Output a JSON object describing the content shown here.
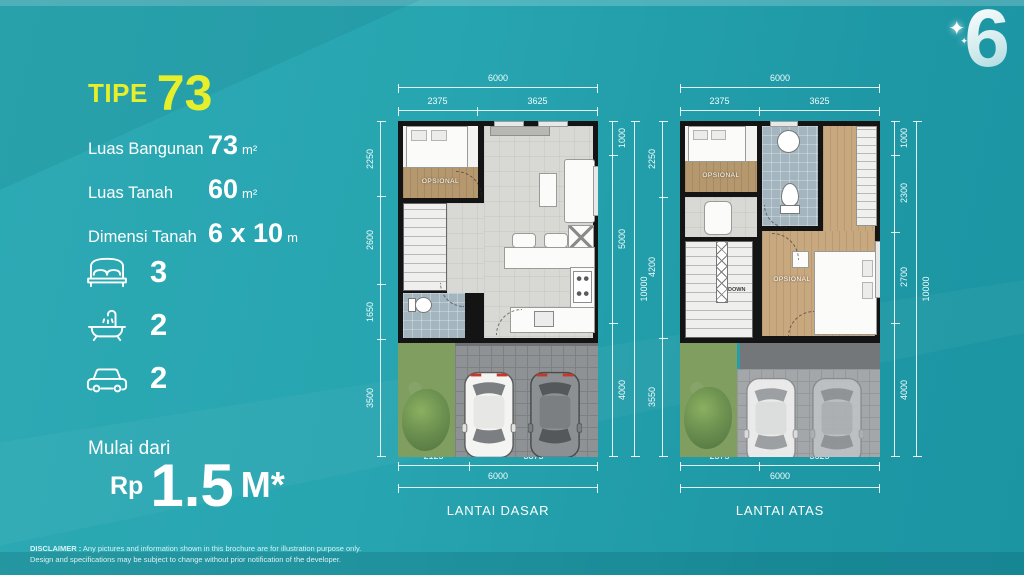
{
  "logo": {
    "text": "6",
    "sparkle": "✦"
  },
  "title": {
    "prefix": "TIPE",
    "number": "73"
  },
  "specs": [
    {
      "label": "Luas Bangunan",
      "value": "73",
      "unit": "m²"
    },
    {
      "label": "Luas Tanah",
      "value": "60",
      "unit": "m²"
    },
    {
      "label": "Dimensi Tanah",
      "value": "6 x 10",
      "unit": "m"
    }
  ],
  "features": [
    {
      "name": "bedrooms",
      "count": "3"
    },
    {
      "name": "bathrooms",
      "count": "2"
    },
    {
      "name": "carports",
      "count": "2"
    }
  ],
  "price": {
    "label": "Mulai dari",
    "currency": "Rp",
    "amount": "1.5",
    "unit": "M*"
  },
  "disclaimer": {
    "heading": "DISCLAIMER :",
    "line1": "Any pictures and information shown in this brochure are for illustration purpose only.",
    "line2": "Design and specifications may be subject to change without prior notification of the developer."
  },
  "plans": [
    {
      "caption": "LANTAI DASAR",
      "top": {
        "total": "6000",
        "segments": [
          "2375",
          "3625"
        ]
      },
      "bottom": {
        "total": "6000",
        "segments": [
          "2125",
          "3875"
        ]
      },
      "left": {
        "segments": [
          "2250",
          "2600",
          "1650",
          "3500"
        ]
      },
      "right": {
        "total": "10000",
        "segments": [
          "1000",
          "5000",
          "4000"
        ]
      },
      "room_labels": {
        "opsional": "OPSIONAL",
        "stairs": "UP"
      }
    },
    {
      "caption": "LANTAI ATAS",
      "top": {
        "total": "6000",
        "segments": [
          "2375",
          "3625"
        ]
      },
      "bottom": {
        "total": "6000",
        "segments": [
          "2375",
          "3625"
        ]
      },
      "left": {
        "segments": [
          "2250",
          "4200",
          "3550"
        ]
      },
      "right": {
        "total": "10000",
        "segments": [
          "1000",
          "2300",
          "2700",
          "4000"
        ]
      },
      "room_labels": {
        "opsional_1": "OPSIONAL",
        "opsional_2": "OPSIONAL",
        "stairs": "DOWN"
      }
    }
  ],
  "colors": {
    "background_teal": "#23a3ae",
    "accent_yellow": "#e7ee2a",
    "wall_black": "#141414",
    "wood": "#b5986d",
    "bath_tile": "#a3b5be",
    "grass": "#7f9e60"
  }
}
